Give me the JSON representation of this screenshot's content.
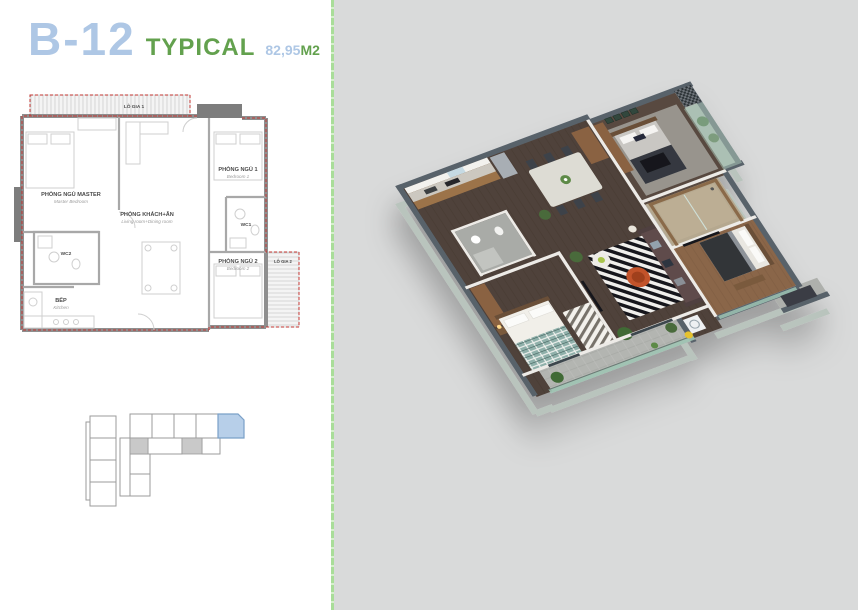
{
  "title": {
    "unit": "B-12",
    "type_label": "TYPICAL",
    "area": "82,95",
    "area_unit": "M2"
  },
  "floor_plan": {
    "labels": {
      "lo_gia_1": {
        "vi": "LÔ GIA 1"
      },
      "master": {
        "vi": "PHÒNG NGỦ MASTER",
        "en": "Master Bedroom"
      },
      "living": {
        "vi": "PHÒNG KHÁCH+ĂN",
        "en": "Living room+Dining room"
      },
      "bedroom1": {
        "vi": "PHÒNG NGỦ 1",
        "en": "Bedroom 1"
      },
      "wc1": {
        "vi": "WC1"
      },
      "wc2": {
        "vi": "WC2"
      },
      "bedroom2": {
        "vi": "PHÒNG NGỦ 2",
        "en": "Bedroom 2"
      },
      "lo_gia_2": {
        "vi": "LÔ GIA 2"
      },
      "kitchen": {
        "vi": "BẾP",
        "en": "Kitchen"
      }
    }
  },
  "colors": {
    "accent_blue": "#aec7e5",
    "accent_green": "#63a14e",
    "divider_green": "#a9dd99",
    "panel_gray": "#d9dada",
    "plan_boundary_red": "#c23430",
    "keyplan_highlight": "#b7cfe9",
    "wall_top_slate": "#59626b",
    "wall_face_sage": "#b9c4bd",
    "floor_dark_wood": "#50423a"
  }
}
